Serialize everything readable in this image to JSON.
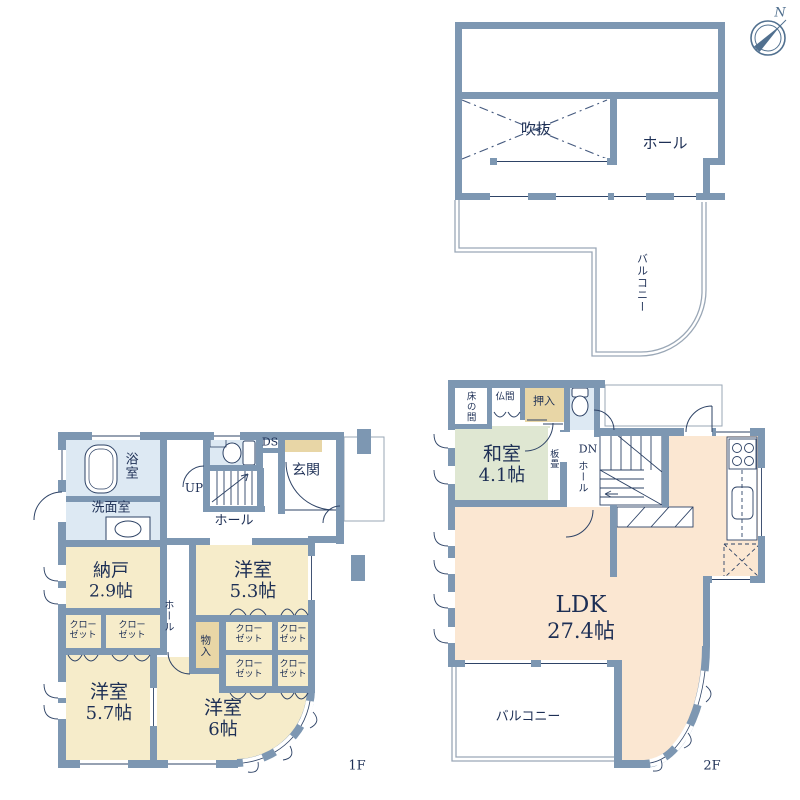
{
  "colors": {
    "wall": "#7d97b2",
    "line": "#2e4366",
    "text": "#1d2f55",
    "thin": "#9aa7b6",
    "cream": "#f6ecca",
    "green": "#dfe7d2",
    "peach": "#fbe7d2",
    "blue": "#dde9f3",
    "tan": "#e8d6a6"
  },
  "compass": {
    "north": "N"
  },
  "f1": {
    "floor_label": "1F",
    "bath": "浴室",
    "washroom": "洗面室",
    "ds": "DS",
    "entrance": "玄関",
    "up": "UP",
    "hall": "ホール",
    "hall_v": "ホール",
    "storage": {
      "name": "納戸",
      "size": "2.9帖"
    },
    "closet": "クローゼット",
    "monoire": "物入",
    "west53": {
      "name": "洋室",
      "size": "5.3帖"
    },
    "west57": {
      "name": "洋室",
      "size": "5.7帖"
    },
    "west6": {
      "name": "洋室",
      "size": "6帖"
    }
  },
  "f2": {
    "floor_label": "2F",
    "void": "吹抜",
    "hall_upper": "ホール",
    "balcony_upper": "バルコニー",
    "tokonoma": "床の間",
    "butsuma": "仏間",
    "oshiire": "押入",
    "washitsu": {
      "name": "和室",
      "size": "4.1帖"
    },
    "itatami": "板畳",
    "dn": "DN",
    "hall_v": "ホール",
    "ldk": {
      "name": "LDK",
      "size": "27.4帖"
    },
    "balcony": "バルコニー"
  }
}
